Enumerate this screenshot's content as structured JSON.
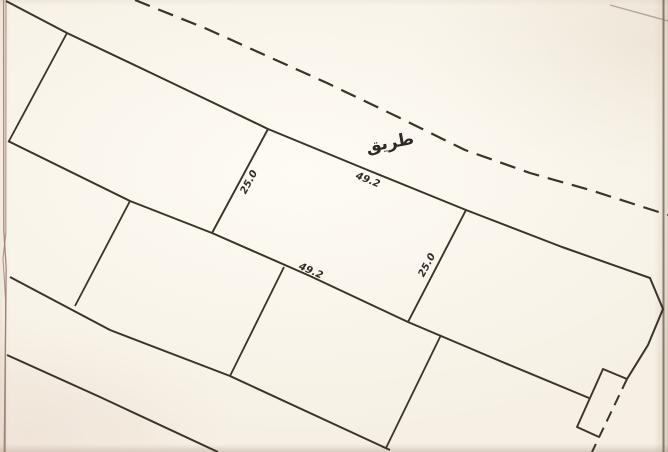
{
  "road": {
    "name_label": "طريق"
  },
  "parcel": {
    "width_top": "49.2",
    "width_bottom": "49.2",
    "depth_left": "25.0",
    "depth_right": "25.0"
  },
  "colors": {
    "paper": "#f6f0e4",
    "ink": "#3a332a",
    "label_ink": "#2f2921",
    "frame_left": "#9a7a6e",
    "frame_right": "#6a594e",
    "scan_edge_faint": "#7e736a"
  }
}
